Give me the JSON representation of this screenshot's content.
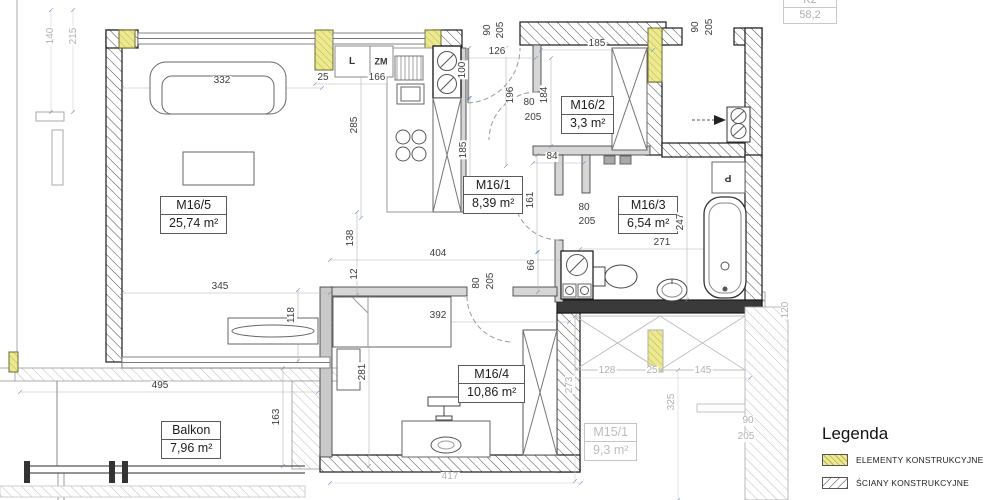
{
  "legend": {
    "title": "Legenda",
    "items": [
      {
        "label": "ELEMENTY KONSTRUKCYJNE",
        "swatch": "yellow-hatch",
        "color": "#ece98e"
      },
      {
        "label": "ŚCIANY KONSTRUKCYJNE",
        "swatch": "diagonal-hatch",
        "color": "#ffffff"
      },
      {
        "label": "ŚCIANY DZIAŁOWE (możliwość",
        "swatch": "grey",
        "color": "#e3e3e3"
      }
    ]
  },
  "rooms": [
    {
      "name": "M16/5",
      "area": "25,74 m²"
    },
    {
      "name": "M16/1",
      "area": "8,39 m²"
    },
    {
      "name": "M16/2",
      "area": "3,3 m²"
    },
    {
      "name": "M16/3",
      "area": "6,54 m²"
    },
    {
      "name": "M16/4",
      "area": "10,86 m²"
    },
    {
      "name": "Balkon",
      "area": "7,96 m²"
    },
    {
      "name": "M15/1",
      "area": "9,3 m²"
    }
  ],
  "fixture_labels": {
    "l": "L",
    "zm": "ZM",
    "p": "P"
  },
  "corner_table": {
    "row1": "K2",
    "row2": "58,2"
  },
  "colors": {
    "structural_yellow": "#ece98e",
    "wall_hatch": "#4a4a4a",
    "dim_text": "#3c3c3c",
    "dim_grey": "#b2b2b2"
  },
  "dimensions": [
    {
      "t": "140",
      "x": 51,
      "y": 36,
      "v": 1,
      "g": 1
    },
    {
      "t": "215",
      "x": 74,
      "y": 36,
      "v": 1,
      "g": 1
    },
    {
      "t": "332",
      "x": 222,
      "y": 81
    },
    {
      "t": "25",
      "x": 323,
      "y": 78
    },
    {
      "t": "166",
      "x": 377,
      "y": 78
    },
    {
      "t": "285",
      "x": 355,
      "y": 125,
      "v": 1
    },
    {
      "t": "100",
      "x": 463,
      "y": 70,
      "v": 1
    },
    {
      "t": "90",
      "x": 488,
      "y": 30,
      "v": 1
    },
    {
      "t": "205",
      "x": 501,
      "y": 30,
      "v": 1
    },
    {
      "t": "126",
      "x": 497,
      "y": 52
    },
    {
      "t": "196",
      "x": 511,
      "y": 95,
      "v": 1
    },
    {
      "t": "185",
      "x": 597,
      "y": 44
    },
    {
      "t": "184",
      "x": 545,
      "y": 95,
      "v": 1
    },
    {
      "t": "80",
      "x": 529,
      "y": 103
    },
    {
      "t": "205",
      "x": 533,
      "y": 118
    },
    {
      "t": "185",
      "x": 464,
      "y": 150,
      "v": 1
    },
    {
      "t": "84",
      "x": 552,
      "y": 157
    },
    {
      "t": "161",
      "x": 531,
      "y": 200,
      "v": 1
    },
    {
      "t": "80",
      "x": 584,
      "y": 208
    },
    {
      "t": "205",
      "x": 587,
      "y": 222
    },
    {
      "t": "247",
      "x": 681,
      "y": 222,
      "v": 1
    },
    {
      "t": "271",
      "x": 662,
      "y": 243
    },
    {
      "t": "138",
      "x": 351,
      "y": 238,
      "v": 1
    },
    {
      "t": "12",
      "x": 355,
      "y": 274,
      "v": 1
    },
    {
      "t": "404",
      "x": 438,
      "y": 254
    },
    {
      "t": "66",
      "x": 532,
      "y": 265,
      "v": 1
    },
    {
      "t": "80",
      "x": 477,
      "y": 283,
      "v": 1
    },
    {
      "t": "205",
      "x": 491,
      "y": 281,
      "v": 1
    },
    {
      "t": "392",
      "x": 438,
      "y": 316
    },
    {
      "t": "118",
      "x": 292,
      "y": 315,
      "v": 1
    },
    {
      "t": "345",
      "x": 220,
      "y": 287
    },
    {
      "t": "281",
      "x": 363,
      "y": 372,
      "v": 1
    },
    {
      "t": "495",
      "x": 160,
      "y": 386
    },
    {
      "t": "163",
      "x": 277,
      "y": 417,
      "v": 1
    },
    {
      "t": "90",
      "x": 696,
      "y": 27,
      "v": 1
    },
    {
      "t": "205",
      "x": 710,
      "y": 27,
      "v": 1
    },
    {
      "t": "417",
      "x": 450,
      "y": 477,
      "g": 1
    },
    {
      "t": "128",
      "x": 607,
      "y": 371,
      "g": 1
    },
    {
      "t": "25",
      "x": 652,
      "y": 371,
      "g": 1
    },
    {
      "t": "145",
      "x": 703,
      "y": 371,
      "g": 1
    },
    {
      "t": "273",
      "x": 570,
      "y": 385,
      "v": 1,
      "g": 1
    },
    {
      "t": "325",
      "x": 672,
      "y": 402,
      "v": 1,
      "g": 1
    },
    {
      "t": "90",
      "x": 748,
      "y": 421,
      "g": 1
    },
    {
      "t": "205",
      "x": 746,
      "y": 437,
      "g": 1
    },
    {
      "t": "120",
      "x": 786,
      "y": 310,
      "v": 1,
      "g": 1
    }
  ]
}
